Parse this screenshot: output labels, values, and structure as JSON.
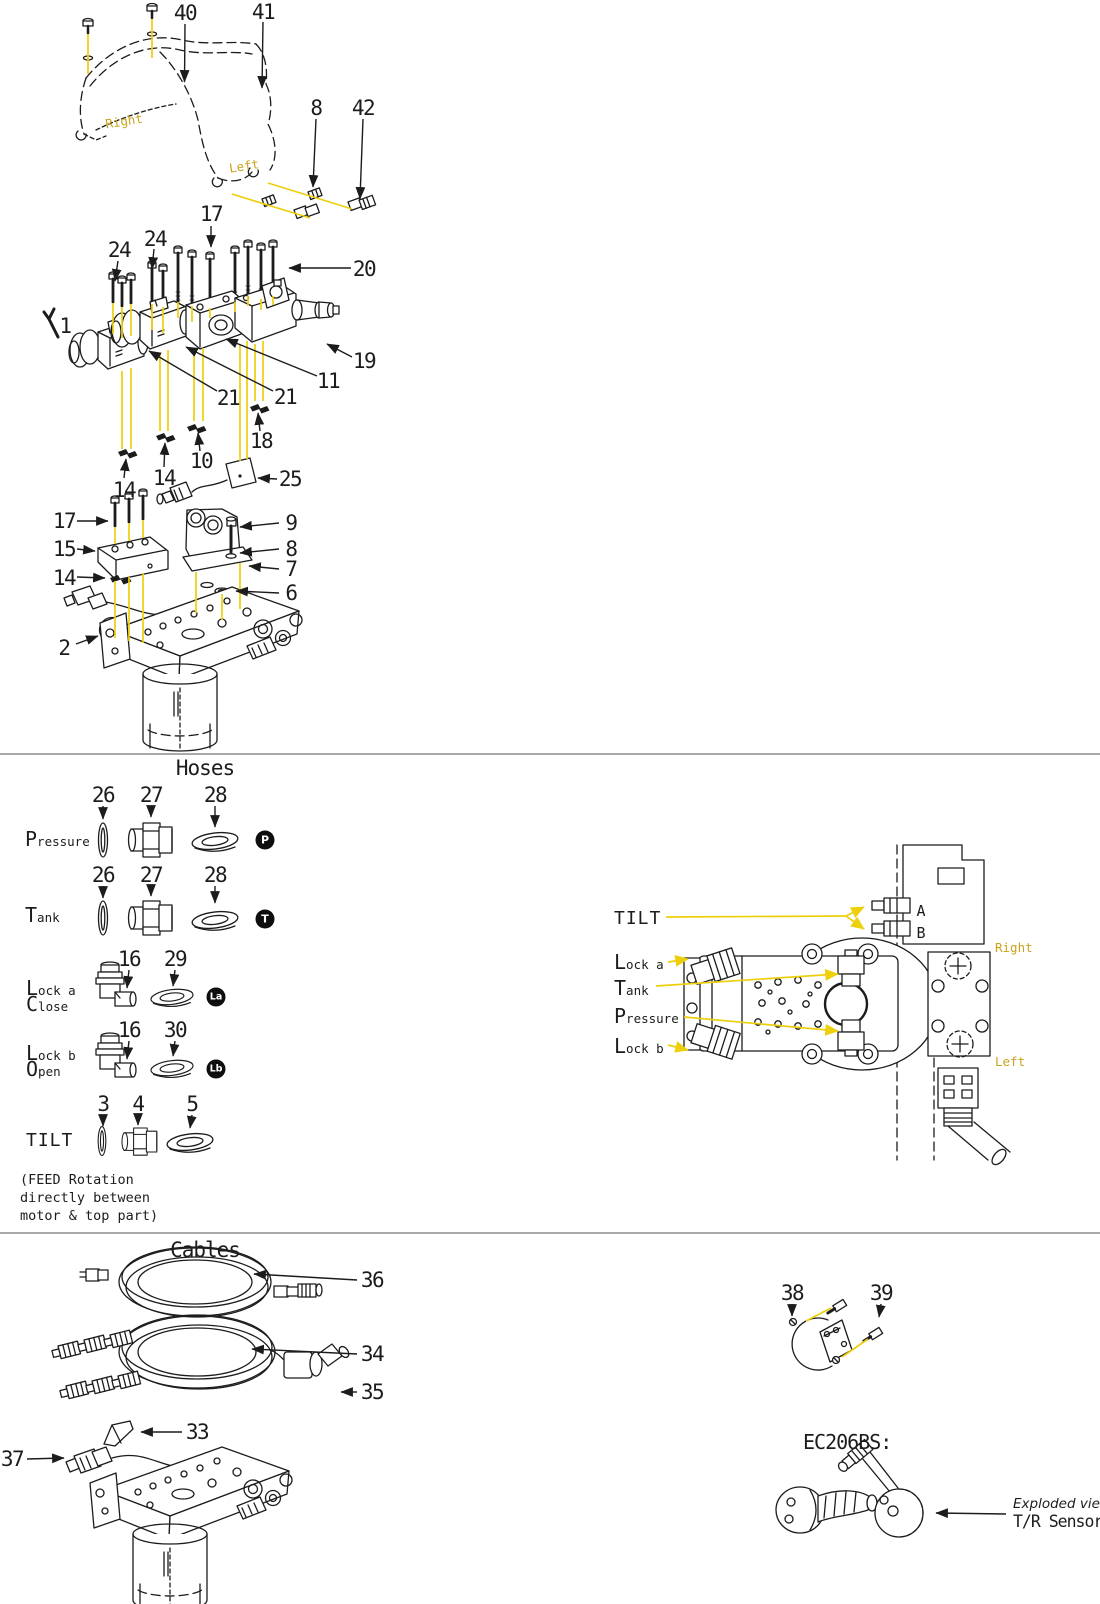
{
  "colors": {
    "line": "#1c1c1c",
    "leader_yellow": "#eecf0b",
    "gold_text": "#c8a41c",
    "divider": "#a9a9a9",
    "badge_bg": "#0e0e0e",
    "badge_fg": "#ffffff",
    "background": "#ffffff"
  },
  "top_section": {
    "orientation": {
      "right": "Right",
      "left": "Left"
    },
    "callouts": {
      "n40": "40",
      "n41": "41",
      "n8_top": "8",
      "n42": "42",
      "n17_top": "17",
      "n24_left": "24",
      "n24_mid": "24",
      "n20": "20",
      "n1": "1",
      "n21_left": "21",
      "n21_right": "21",
      "n11": "11",
      "n19": "19",
      "n18": "18",
      "n10": "10",
      "n14_a": "14",
      "n25": "25",
      "n14_b": "14",
      "n17_block": "17",
      "n9": "9",
      "n15": "15",
      "n8_washer": "8",
      "n14_c": "14",
      "n7": "7",
      "n6": "6",
      "n2": "2"
    }
  },
  "hoses_section": {
    "title": "Hoses",
    "rows": {
      "pressure": {
        "label": "Pressure",
        "n1": "26",
        "n2": "27",
        "n3": "28",
        "badge": "P"
      },
      "tank": {
        "label": "Tank",
        "n1": "26",
        "n2": "27",
        "n3": "28",
        "badge": "T"
      },
      "lock_a": {
        "label": "Lock a",
        "label2": "Close",
        "n1": "16",
        "n2": "29",
        "badge": "La"
      },
      "lock_b": {
        "label": "Lock b",
        "label2": "Open",
        "n1": "16",
        "n2": "30",
        "badge": "Lb"
      },
      "tilt": {
        "label": "TILT",
        "n1": "3",
        "n2": "4",
        "n3": "5"
      }
    },
    "note_line1": "(FEED Rotation",
    "note_line2": "directly between",
    "note_line3": "motor & top part)",
    "valve_view": {
      "tilt": "TILT",
      "port_a": "A",
      "port_b": "B",
      "lock_a": "Lock a",
      "tank": "Tank",
      "pressure": "Pressure",
      "lock_b": "Lock b",
      "right": "Right",
      "left": "Left"
    }
  },
  "cables_section": {
    "title": "Cables",
    "callouts": {
      "n36": "36",
      "n34": "34",
      "n35": "35",
      "n33": "33",
      "n37": "37",
      "n38": "38",
      "n39": "39"
    },
    "ec_model": "EC206BS:",
    "exploded_view": "Exploded view",
    "tr_sensors": "T/R Sensors"
  }
}
